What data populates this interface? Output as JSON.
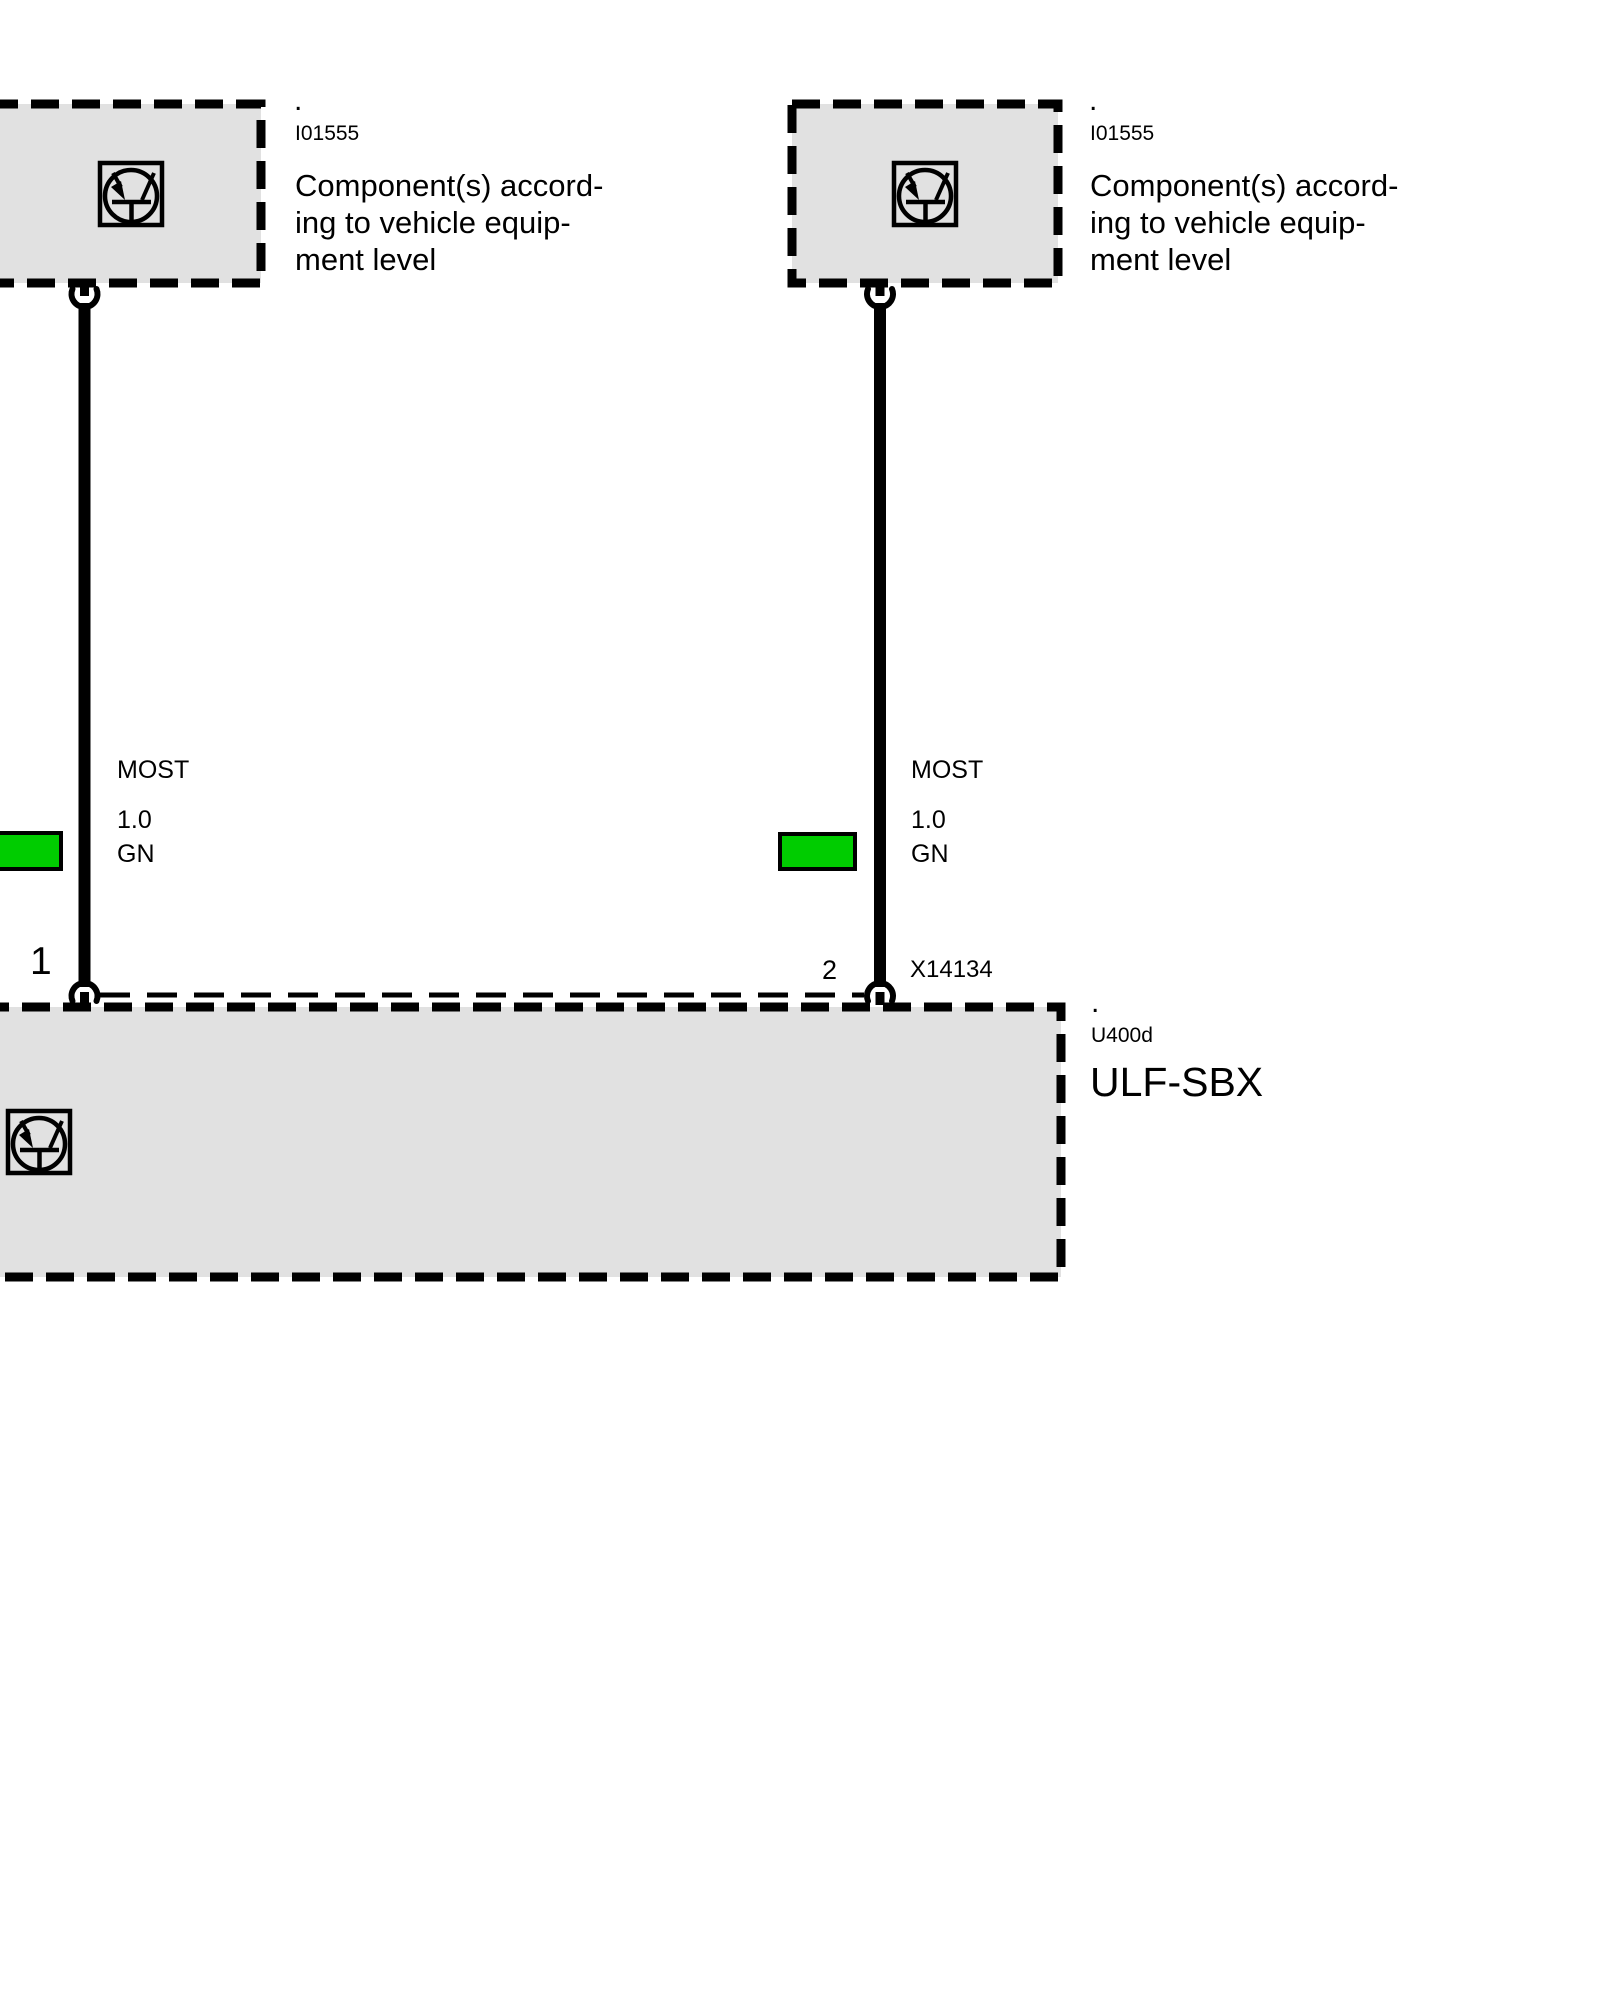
{
  "colors": {
    "box_fill": "#e1e1e1",
    "wire_swatch_green": "#00cc00",
    "line_black": "#000000"
  },
  "boxes": {
    "top_left": {
      "dot": ".",
      "code": "I01555",
      "label_lines": [
        "Component(s) accord-",
        "ing to vehicle equip-",
        "ment level"
      ],
      "icon": "equipment-level-icon"
    },
    "top_right": {
      "dot": ".",
      "code": "I01555",
      "label_lines": [
        "Component(s) accord-",
        "ing to vehicle equip-",
        "ment level"
      ],
      "icon": "equipment-level-icon"
    },
    "bottom": {
      "dot": ".",
      "code": "U400d",
      "name": "ULF-SBX",
      "icon": "equipment-level-icon"
    }
  },
  "wires": {
    "left": {
      "pin": "1",
      "bus": "MOST",
      "cross_section": "1.0",
      "color_code": "GN"
    },
    "right": {
      "pin": "2",
      "bus": "MOST",
      "cross_section": "1.0",
      "color_code": "GN"
    }
  },
  "connector_label": "X14134"
}
